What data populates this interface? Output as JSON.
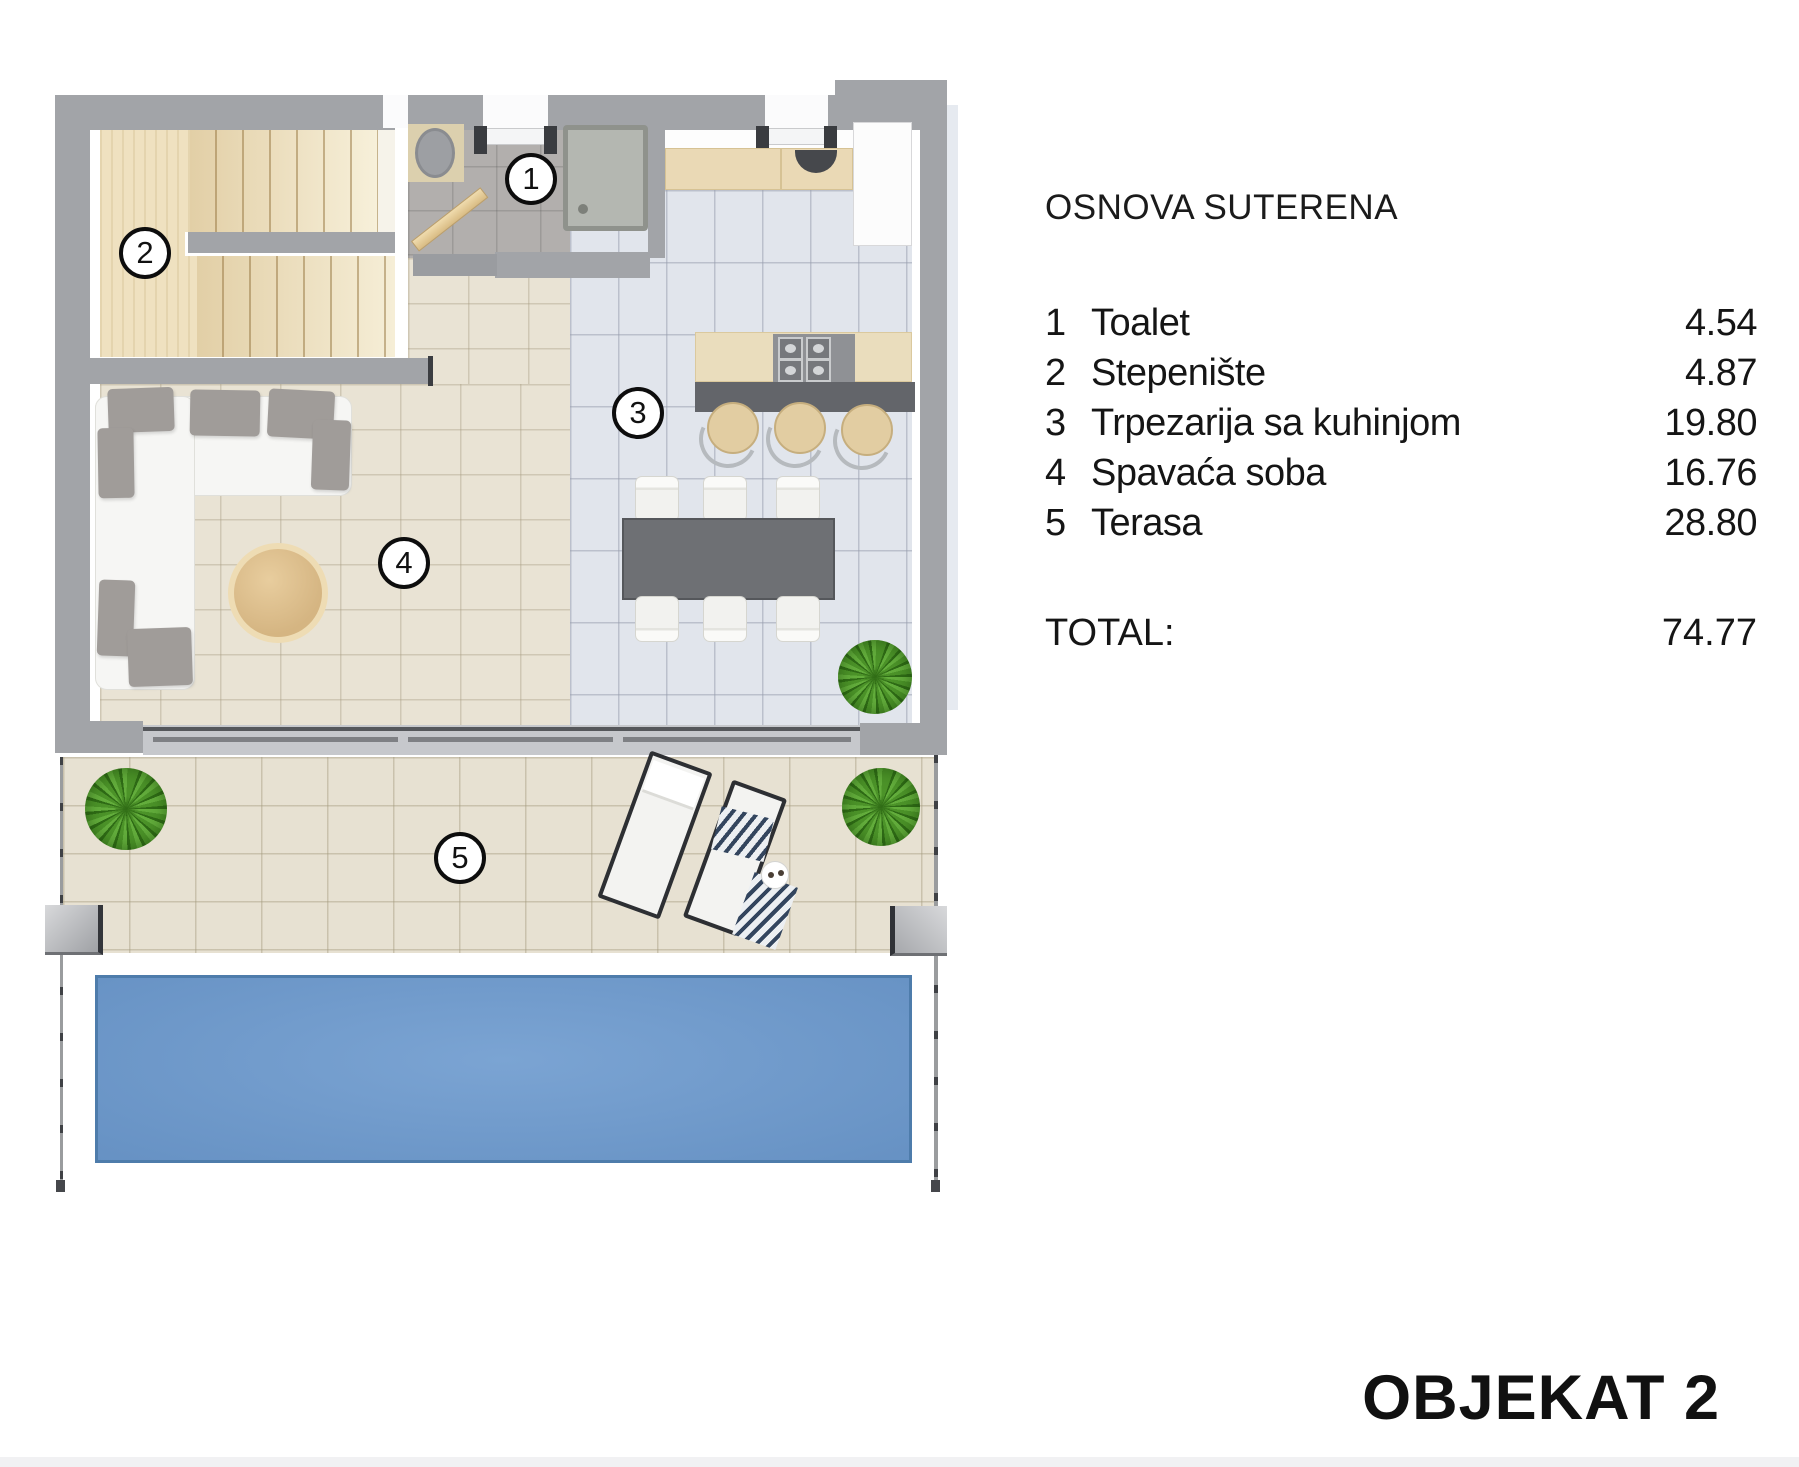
{
  "plan_title": "OSNOVA SUTERENA",
  "legend": {
    "items": [
      {
        "num": "1",
        "label": "Toalet",
        "area": "4.54"
      },
      {
        "num": "2",
        "label": "Stepenište",
        "area": "4.87"
      },
      {
        "num": "3",
        "label": "Trpezarija sa kuhinjom",
        "area": "19.80"
      },
      {
        "num": "4",
        "label": "Spavaća soba",
        "area": "16.76"
      },
      {
        "num": "5",
        "label": "Terasa",
        "area": "28.80"
      }
    ],
    "total_label": "TOTAL:",
    "total_value": "74.77"
  },
  "object_title": "OBJEKAT 2",
  "room_markers": [
    "1",
    "2",
    "3",
    "4",
    "5"
  ],
  "colors": {
    "wall": "#a2a4a8",
    "pool": "#6792c4",
    "wood_floor": "#efe1c0",
    "tile_warm": "#e9e3d4",
    "tile_cool": "#e1e5ec",
    "counter": "#ead9b5",
    "furniture_dark": "#63656a",
    "plant": "#63ad3c"
  }
}
